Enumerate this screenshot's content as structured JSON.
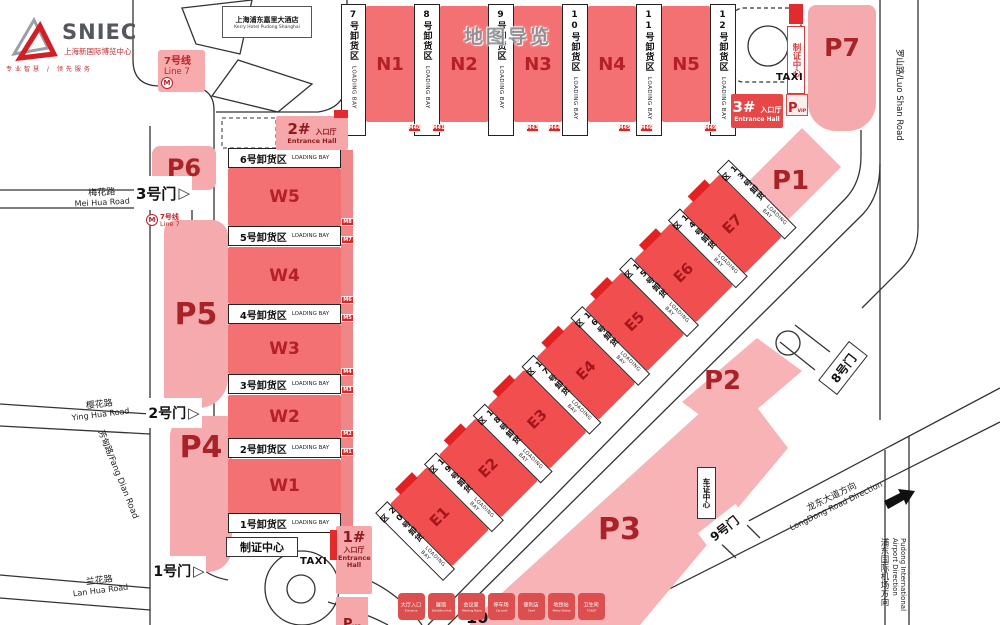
{
  "logo": {
    "brand": "SNIEC",
    "brand_cn": "上海新国际博览中心",
    "tagline": "专业智慧 / 领先服务"
  },
  "watermark": "地图导览",
  "hotel": {
    "cn": "上海浦东嘉里大酒店",
    "en": "Kerry Hotel Pudong Shanghai"
  },
  "metro": {
    "cn": "7号线",
    "en": "Line 7"
  },
  "halls": {
    "north": [
      "N1",
      "N2",
      "N3",
      "N4",
      "N5"
    ],
    "west": [
      "W5",
      "W4",
      "W3",
      "W2",
      "W1"
    ],
    "east": [
      "E1",
      "E2",
      "E3",
      "E4",
      "E5",
      "E6",
      "E7"
    ]
  },
  "bays": {
    "en": "LOADING BAY",
    "north": [
      "7号卸货区",
      "8号卸货区",
      "9号卸货区",
      "10号卸货区",
      "11号卸货区",
      "12号卸货区"
    ],
    "west": [
      "6号卸货区",
      "5号卸货区",
      "4号卸货区",
      "3号卸货区",
      "2号卸货区",
      "1号卸货区"
    ],
    "east": [
      "20号卸货区",
      "19号卸货区",
      "18号卸货区",
      "17号卸货区",
      "16号卸货区",
      "15号卸货区",
      "14号卸货区",
      "13号卸货区"
    ]
  },
  "parking": {
    "p1": "P1",
    "p2": "P2",
    "p3": "P3",
    "p4": "P4",
    "p5": "P5",
    "p6": "P6",
    "p7": "P7",
    "vip_p": "P",
    "vip": "VIP"
  },
  "entrances": {
    "e1": {
      "num": "1#",
      "cn": "入口厅",
      "en": "Entrance Hall"
    },
    "e2": {
      "num": "2#",
      "cn": "入口厅",
      "en": "Entrance Hall"
    },
    "e3": {
      "num": "3#",
      "cn": "入口厅",
      "en": "Entrance Hall"
    }
  },
  "gates": {
    "g1": "1号门",
    "g2": "2号门",
    "g3": "3号门",
    "g8": "8号门",
    "g9": "9号门",
    "g10": "10"
  },
  "centers": {
    "badge_top": "制证中心",
    "badge_bottom": "制证中心",
    "vehicle": "车证中心"
  },
  "taxi": "TAXI",
  "roads": {
    "meihua_cn": "梅花路",
    "meihua_en": "Mei Hua Road",
    "yinghua_cn": "樱花路",
    "yinghua_en": "Ying Hua Road",
    "lanhua_cn": "兰花路",
    "lanhua_en": "Lan Hua Road",
    "fangdian": "芳甸路/Fang Dian Road",
    "luoshan": "罗山路/Luo Shan Road",
    "longdong_cn": "龙东大道方向",
    "longdong_en": "LongDong Road Direction",
    "airport_cn": "浦东国际机场方向",
    "airport_en": "Pudong International Airport Direction"
  },
  "legend": [
    {
      "cn": "大厅入口",
      "en": "Entrance"
    },
    {
      "cn": "展馆",
      "en": "Exhibition hall"
    },
    {
      "cn": "会议室",
      "en": "Meeting Room"
    },
    {
      "cn": "停车场",
      "en": "Car park"
    },
    {
      "cn": "便利店",
      "en": "Store"
    },
    {
      "cn": "地铁站",
      "en": "Metro Station"
    },
    {
      "cn": "卫生间",
      "en": "TOILET"
    }
  ],
  "m_labels": {
    "west": [
      "M8",
      "M7",
      "M6",
      "M5",
      "M4",
      "M3",
      "M2",
      "M1"
    ],
    "north": [
      "M40",
      "M41",
      "M43",
      "M44",
      "M45",
      "M46",
      "M49"
    ]
  },
  "colors": {
    "hall_red": "#f37172",
    "hall_east_red": "#f14e4f",
    "parking_pink": "#f5abad",
    "entrance_red": "#e84748",
    "accent_dark_red": "#b3202a"
  }
}
